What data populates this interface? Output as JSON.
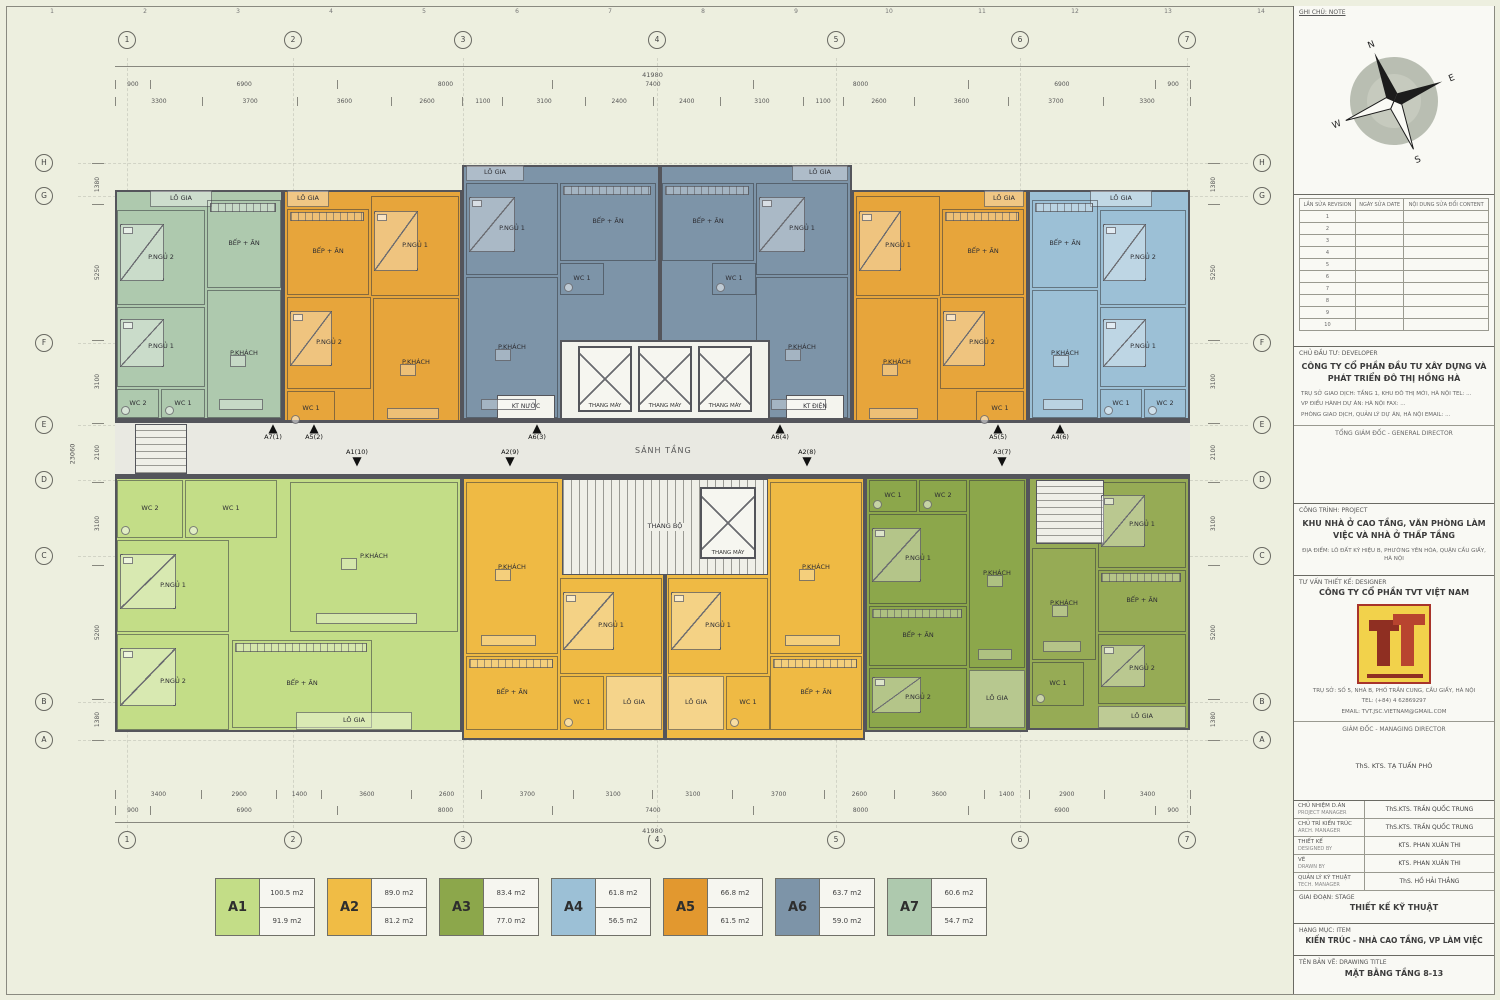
{
  "frame_ruler": [
    "1",
    "2",
    "3",
    "4",
    "5",
    "6",
    "7",
    "8",
    "9",
    "10",
    "11",
    "12",
    "13",
    "14",
    "15",
    "16"
  ],
  "legend": {
    "items": [
      {
        "code": "A1",
        "color": "#c3dd87",
        "area_top": "100.5 m2",
        "area_bottom": "91.9 m2"
      },
      {
        "code": "A2",
        "color": "#f0bc45",
        "area_top": "89.0 m2",
        "area_bottom": "81.2 m2"
      },
      {
        "code": "A3",
        "color": "#8ca74b",
        "area_top": "83.4 m2",
        "area_bottom": "77.0 m2"
      },
      {
        "code": "A4",
        "color": "#9cc0d6",
        "area_top": "61.8 m2",
        "area_bottom": "56.5 m2"
      },
      {
        "code": "A5",
        "color": "#e2982f",
        "area_top": "66.8 m2",
        "area_bottom": "61.5 m2"
      },
      {
        "code": "A6",
        "color": "#7d94a8",
        "area_top": "63.7 m2",
        "area_bottom": "59.0 m2"
      },
      {
        "code": "A7",
        "color": "#aec9ae",
        "area_top": "60.6 m2",
        "area_bottom": "54.7 m2"
      }
    ]
  },
  "plan": {
    "corridor_label": "SẢNH TẦNG",
    "core_labels": {
      "lift": "THANG MÁY",
      "stair": "THANG BỘ",
      "kt_nuoc": "KT NƯỚC",
      "kt_dien": "KT ĐIỆN"
    },
    "grid": {
      "cols": [
        "1",
        "2",
        "3",
        "4",
        "5",
        "6",
        "7"
      ],
      "col_x": [
        127,
        293,
        463,
        657,
        836,
        1020,
        1187
      ],
      "rows": [
        "H",
        "G",
        "F",
        "E",
        "D",
        "C",
        "B",
        "A"
      ],
      "row_y": [
        163,
        196,
        343,
        425,
        480,
        556,
        702,
        740
      ]
    },
    "dims": {
      "overall_h": "41980",
      "overall_v": "23060",
      "segments": [
        "900",
        "6900",
        "8000",
        "7400",
        "8000",
        "6900",
        "900"
      ],
      "top_fine": [
        "3300",
        "3700",
        "3600",
        "2600",
        "1100",
        "3100",
        "2400",
        "2400",
        "3100",
        "1100",
        "2600",
        "3600",
        "3700",
        "3300"
      ],
      "bottom_fine": [
        "3400",
        "2900",
        "1400",
        "3600",
        "2600",
        "3700",
        "3100",
        "3100",
        "3700",
        "2600",
        "3600",
        "1400",
        "2900",
        "3400"
      ],
      "left": [
        "1380",
        "5250",
        "3100",
        "2100",
        "3100",
        "5200",
        "1380"
      ],
      "right": [
        "1380",
        "5250",
        "3100",
        "2100",
        "3100",
        "5200",
        "1380"
      ]
    },
    "arrows_up": [
      {
        "label": "A7(1)",
        "x": 273
      },
      {
        "label": "A5(2)",
        "x": 314
      },
      {
        "label": "A6(3)",
        "x": 537
      },
      {
        "label": "A6(4)",
        "x": 780
      },
      {
        "label": "A5(5)",
        "x": 998
      },
      {
        "label": "A4(6)",
        "x": 1060
      }
    ],
    "arrows_down": [
      {
        "label": "A1(10)",
        "x": 357
      },
      {
        "label": "A2(9)",
        "x": 510
      },
      {
        "label": "A2(8)",
        "x": 807
      },
      {
        "label": "A3(7)",
        "x": 1002
      }
    ],
    "units": [
      {
        "id": "A7-1",
        "color": "#aec9ae",
        "x": 115,
        "y": 190,
        "w": 168,
        "h": 230,
        "rooms": [
          {
            "label": "LÔ GIA",
            "x": 150,
            "y": 190,
            "w": 62,
            "h": 17,
            "kind": "loggia"
          },
          {
            "label": "P.NGỦ 2",
            "x": 117,
            "y": 210,
            "w": 88,
            "h": 95,
            "kind": "bed"
          },
          {
            "label": "P.NGỦ 1",
            "x": 117,
            "y": 307,
            "w": 88,
            "h": 80,
            "kind": "bed"
          },
          {
            "label": "WC 2",
            "x": 117,
            "y": 389,
            "w": 42,
            "h": 29,
            "kind": "wc"
          },
          {
            "label": "WC 1",
            "x": 161,
            "y": 389,
            "w": 44,
            "h": 29,
            "kind": "wc"
          },
          {
            "label": "BẾP + ĂN",
            "x": 207,
            "y": 200,
            "w": 74,
            "h": 88,
            "kind": "kitchen"
          },
          {
            "label": "P.KHÁCH",
            "x": 207,
            "y": 290,
            "w": 74,
            "h": 128,
            "kind": "sofa"
          }
        ]
      },
      {
        "id": "A5-2",
        "color": "#e7a53b",
        "x": 283,
        "y": 190,
        "w": 179,
        "h": 240,
        "rooms": [
          {
            "label": "LÔ GIA",
            "x": 287,
            "y": 190,
            "w": 42,
            "h": 17,
            "kind": "loggia"
          },
          {
            "label": "BẾP + ĂN",
            "x": 287,
            "y": 209,
            "w": 82,
            "h": 86,
            "kind": "kitchen"
          },
          {
            "label": "P.NGỦ 1",
            "x": 371,
            "y": 196,
            "w": 88,
            "h": 100,
            "kind": "bed"
          },
          {
            "label": "P.NGỦ 2",
            "x": 287,
            "y": 297,
            "w": 84,
            "h": 92,
            "kind": "bed"
          },
          {
            "label": "WC 1",
            "x": 287,
            "y": 391,
            "w": 48,
            "h": 36,
            "kind": "wc"
          },
          {
            "label": "P.KHÁCH",
            "x": 373,
            "y": 298,
            "w": 86,
            "h": 129,
            "kind": "sofa"
          }
        ]
      },
      {
        "id": "A6-3",
        "color": "#7d94a8",
        "x": 462,
        "y": 165,
        "w": 198,
        "h": 255,
        "rooms": [
          {
            "label": "LÔ GIA",
            "x": 466,
            "y": 165,
            "w": 58,
            "h": 16,
            "kind": "loggia"
          },
          {
            "label": "P.NGỦ 1",
            "x": 466,
            "y": 183,
            "w": 92,
            "h": 92,
            "kind": "bed"
          },
          {
            "label": "BẾP + ĂN",
            "x": 560,
            "y": 183,
            "w": 96,
            "h": 78,
            "kind": "kitchen"
          },
          {
            "label": "WC 1",
            "x": 560,
            "y": 263,
            "w": 44,
            "h": 32,
            "kind": "wc"
          },
          {
            "label": "P.KHÁCH",
            "x": 466,
            "y": 277,
            "w": 92,
            "h": 141,
            "kind": "sofa"
          }
        ]
      },
      {
        "id": "A6-4",
        "color": "#7d94a8",
        "x": 660,
        "y": 165,
        "w": 192,
        "h": 255,
        "rooms": [
          {
            "label": "LÔ GIA",
            "x": 792,
            "y": 165,
            "w": 56,
            "h": 16,
            "kind": "loggia"
          },
          {
            "label": "P.NGỦ 1",
            "x": 756,
            "y": 183,
            "w": 92,
            "h": 92,
            "kind": "bed"
          },
          {
            "label": "BẾP + ĂN",
            "x": 662,
            "y": 183,
            "w": 92,
            "h": 78,
            "kind": "kitchen"
          },
          {
            "label": "WC 1",
            "x": 712,
            "y": 263,
            "w": 44,
            "h": 32,
            "kind": "wc"
          },
          {
            "label": "P.KHÁCH",
            "x": 756,
            "y": 277,
            "w": 92,
            "h": 141,
            "kind": "sofa"
          }
        ]
      },
      {
        "id": "A5-5",
        "color": "#e7a53b",
        "x": 852,
        "y": 190,
        "w": 176,
        "h": 240,
        "rooms": [
          {
            "label": "LÔ GIA",
            "x": 984,
            "y": 190,
            "w": 40,
            "h": 17,
            "kind": "loggia"
          },
          {
            "label": "BẾP + ĂN",
            "x": 942,
            "y": 209,
            "w": 82,
            "h": 86,
            "kind": "kitchen"
          },
          {
            "label": "P.NGỦ 1",
            "x": 856,
            "y": 196,
            "w": 84,
            "h": 100,
            "kind": "bed"
          },
          {
            "label": "P.NGỦ 2",
            "x": 940,
            "y": 297,
            "w": 84,
            "h": 92,
            "kind": "bed"
          },
          {
            "label": "WC 1",
            "x": 976,
            "y": 391,
            "w": 48,
            "h": 36,
            "kind": "wc"
          },
          {
            "label": "P.KHÁCH",
            "x": 856,
            "y": 298,
            "w": 82,
            "h": 129,
            "kind": "sofa"
          }
        ]
      },
      {
        "id": "A4-6",
        "color": "#9cc0d6",
        "x": 1028,
        "y": 190,
        "w": 162,
        "h": 230,
        "rooms": [
          {
            "label": "LÔ GIA",
            "x": 1090,
            "y": 190,
            "w": 62,
            "h": 17,
            "kind": "loggia"
          },
          {
            "label": "P.NGỦ 2",
            "x": 1100,
            "y": 210,
            "w": 86,
            "h": 95,
            "kind": "bed"
          },
          {
            "label": "P.NGỦ 1",
            "x": 1100,
            "y": 307,
            "w": 86,
            "h": 80,
            "kind": "bed"
          },
          {
            "label": "WC 1",
            "x": 1100,
            "y": 389,
            "w": 42,
            "h": 29,
            "kind": "wc"
          },
          {
            "label": "WC 2",
            "x": 1144,
            "y": 389,
            "w": 42,
            "h": 29,
            "kind": "wc"
          },
          {
            "label": "BẾP + ĂN",
            "x": 1032,
            "y": 200,
            "w": 66,
            "h": 88,
            "kind": "kitchen"
          },
          {
            "label": "P.KHÁCH",
            "x": 1032,
            "y": 290,
            "w": 66,
            "h": 128,
            "kind": "sofa"
          }
        ]
      },
      {
        "id": "A1-10",
        "color": "#c3dd87",
        "x": 115,
        "y": 477,
        "w": 347,
        "h": 255,
        "rooms": [
          {
            "label": "WC 2",
            "x": 117,
            "y": 480,
            "w": 66,
            "h": 58,
            "kind": "wc"
          },
          {
            "label": "WC 1",
            "x": 185,
            "y": 480,
            "w": 92,
            "h": 58,
            "kind": "wc"
          },
          {
            "label": "P.NGỦ 1",
            "x": 117,
            "y": 540,
            "w": 112,
            "h": 92,
            "kind": "bed"
          },
          {
            "label": "P.NGỦ 2",
            "x": 117,
            "y": 634,
            "w": 112,
            "h": 96,
            "kind": "bed"
          },
          {
            "label": "P.KHÁCH",
            "x": 290,
            "y": 482,
            "w": 168,
            "h": 150,
            "kind": "sofa"
          },
          {
            "label": "BẾP + ĂN",
            "x": 232,
            "y": 640,
            "w": 140,
            "h": 88,
            "kind": "kitchen"
          },
          {
            "label": "LÔ GIA",
            "x": 296,
            "y": 712,
            "w": 116,
            "h": 18,
            "kind": "loggia"
          }
        ]
      },
      {
        "id": "A2-9",
        "color": "#efba44",
        "x": 462,
        "y": 477,
        "w": 203,
        "h": 263,
        "rooms": [
          {
            "label": "P.KHÁCH",
            "x": 466,
            "y": 482,
            "w": 92,
            "h": 172,
            "kind": "sofa"
          },
          {
            "label": "BẾP + ĂN",
            "x": 466,
            "y": 656,
            "w": 92,
            "h": 74,
            "kind": "kitchen"
          },
          {
            "label": "P.NGỦ 1",
            "x": 560,
            "y": 578,
            "w": 102,
            "h": 96,
            "kind": "bed"
          },
          {
            "label": "WC 1",
            "x": 560,
            "y": 676,
            "w": 44,
            "h": 54,
            "kind": "wc"
          },
          {
            "label": "LÔ GIA",
            "x": 606,
            "y": 676,
            "w": 56,
            "h": 54,
            "kind": "loggia"
          }
        ]
      },
      {
        "id": "A2-8",
        "color": "#efba44",
        "x": 665,
        "y": 477,
        "w": 200,
        "h": 263,
        "rooms": [
          {
            "label": "P.KHÁCH",
            "x": 770,
            "y": 482,
            "w": 92,
            "h": 172,
            "kind": "sofa"
          },
          {
            "label": "BẾP + ĂN",
            "x": 770,
            "y": 656,
            "w": 92,
            "h": 74,
            "kind": "kitchen"
          },
          {
            "label": "P.NGỦ 1",
            "x": 668,
            "y": 578,
            "w": 100,
            "h": 96,
            "kind": "bed"
          },
          {
            "label": "WC 1",
            "x": 726,
            "y": 676,
            "w": 44,
            "h": 54,
            "kind": "wc"
          },
          {
            "label": "LÔ GIA",
            "x": 668,
            "y": 676,
            "w": 56,
            "h": 54,
            "kind": "loggia"
          }
        ]
      },
      {
        "id": "A3-7",
        "color": "#8ca74b",
        "x": 865,
        "y": 477,
        "w": 163,
        "h": 255,
        "rooms": [
          {
            "label": "WC 1",
            "x": 869,
            "y": 480,
            "w": 48,
            "h": 32,
            "kind": "wc"
          },
          {
            "label": "WC 2",
            "x": 919,
            "y": 480,
            "w": 48,
            "h": 32,
            "kind": "wc"
          },
          {
            "label": "P.NGỦ 1",
            "x": 869,
            "y": 514,
            "w": 98,
            "h": 90,
            "kind": "bed"
          },
          {
            "label": "BẾP + ĂN",
            "x": 869,
            "y": 606,
            "w": 98,
            "h": 60,
            "kind": "kitchen"
          },
          {
            "label": "P.NGỦ 2",
            "x": 869,
            "y": 668,
            "w": 98,
            "h": 60,
            "kind": "bed"
          },
          {
            "label": "P.KHÁCH",
            "x": 969,
            "y": 480,
            "w": 56,
            "h": 188,
            "kind": "sofa"
          },
          {
            "label": "LÔ GIA",
            "x": 969,
            "y": 670,
            "w": 56,
            "h": 58,
            "kind": "loggia"
          }
        ]
      },
      {
        "id": "A3-7b",
        "color": "#96ab55",
        "x": 1028,
        "y": 477,
        "w": 162,
        "h": 253,
        "rooms": [
          {
            "label": "P.NGỦ 1",
            "x": 1098,
            "y": 482,
            "w": 88,
            "h": 86,
            "kind": "bed"
          },
          {
            "label": "BẾP + ĂN",
            "x": 1098,
            "y": 570,
            "w": 88,
            "h": 62,
            "kind": "kitchen"
          },
          {
            "label": "P.NGỦ 2",
            "x": 1098,
            "y": 634,
            "w": 88,
            "h": 70,
            "kind": "bed"
          },
          {
            "label": "P.KHÁCH",
            "x": 1032,
            "y": 548,
            "w": 64,
            "h": 112,
            "kind": "sofa"
          },
          {
            "label": "WC 1",
            "x": 1032,
            "y": 662,
            "w": 52,
            "h": 44,
            "kind": "wc"
          },
          {
            "label": "LÔ GIA",
            "x": 1098,
            "y": 706,
            "w": 88,
            "h": 22,
            "kind": "loggia"
          }
        ]
      }
    ]
  },
  "panel": {
    "note_label": "GHI CHÚ: NOTE",
    "compass": {
      "n": "N",
      "e": "E",
      "s": "S",
      "w": "W"
    },
    "revision": {
      "headers": [
        "LẦN SỬA REVISION",
        "NGÀY SỬA DATE",
        "NỘI DUNG SỬA ĐỔI CONTENT"
      ],
      "rows": [
        "1",
        "2",
        "3",
        "4",
        "5",
        "6",
        "7",
        "8",
        "9",
        "10"
      ]
    },
    "developer_label": "CHỦ ĐẦU TƯ: DEVELOPER",
    "developer_name": "CÔNG TY CỔ PHẦN ĐẦU TƯ XÂY DỰNG VÀ PHÁT TRIỂN ĐÔ THỊ HỒNG HÀ",
    "developer_lines": [
      "TRỤ SỞ GIAO DỊCH: TẦNG 1, KHU ĐÔ THỊ MỚI, HÀ NỘI    TEL: ...",
      "VP ĐIỀU HÀNH DỰ ÁN: HÀ NỘI    FAX: ...",
      "PHÒNG GIAO DỊCH, QUẢN LÝ DỰ ÁN, HÀ NỘI    EMAIL: ..."
    ],
    "general_director": "TỔNG GIÁM ĐỐC - GENERAL DIRECTOR",
    "project_label": "CÔNG TRÌNH: PROJECT",
    "project_name": "KHU NHÀ Ở CAO TẦNG, VĂN PHÒNG LÀM VIỆC VÀ NHÀ Ở THẤP TẦNG",
    "project_location": "ĐỊA ĐIỂM: LÔ ĐẤT KÝ HIỆU B, PHƯỜNG YÊN HÒA, QUẬN CẦU GIẤY, HÀ NỘI",
    "designer_label": "TƯ VẤN THIẾT KẾ: DESIGNER",
    "designer_name": "CÔNG TY CỔ PHẦN TVT VIỆT NAM",
    "designer_lines": [
      "TRỤ SỞ: SỐ 5, NHÀ B, PHỐ TRẦN CUNG, CẦU GIẤY, HÀ NỘI",
      "TEL: (+84) 4 62869297",
      "EMAIL: TVT.JSC.VIETNAM@GMAIL.COM"
    ],
    "md_label": "GIÁM ĐỐC - MANAGING DIRECTOR",
    "md_name": "ThS. KTS. TẠ TUẤN PHÓ",
    "personnel": [
      {
        "role_vn": "CHỦ NHIỆM D.ÁN",
        "role_en": "PROJECT MANAGER",
        "name": "ThS.KTS. TRẦN QUỐC TRUNG"
      },
      {
        "role_vn": "CHỦ TRÌ KIẾN TRÚC",
        "role_en": "ARCH. MANAGER",
        "name": "ThS.KTS. TRẦN QUỐC TRUNG"
      },
      {
        "role_vn": "THIẾT KẾ",
        "role_en": "DESIGNED BY",
        "name": "KTS. PHAN XUÂN THI"
      },
      {
        "role_vn": "VẼ",
        "role_en": "DRAWN BY",
        "name": "KTS. PHAN XUÂN THI"
      },
      {
        "role_vn": "QUẢN LÝ KỸ THUẬT",
        "role_en": "TECH. MANAGER",
        "name": "ThS. HỒ HẢI THẮNG"
      }
    ],
    "stage_label": "GIAI ĐOẠN: STAGE",
    "stage": "THIẾT KẾ KỸ THUẬT",
    "item_label": "HẠNG MỤC: ITEM",
    "item": "KIẾN TRÚC - NHÀ CAO TẦNG, VP LÀM VIỆC",
    "title_label": "TÊN BẢN VẼ: DRAWING TITLE",
    "title": "MẶT BẰNG TẦNG 8-13"
  }
}
